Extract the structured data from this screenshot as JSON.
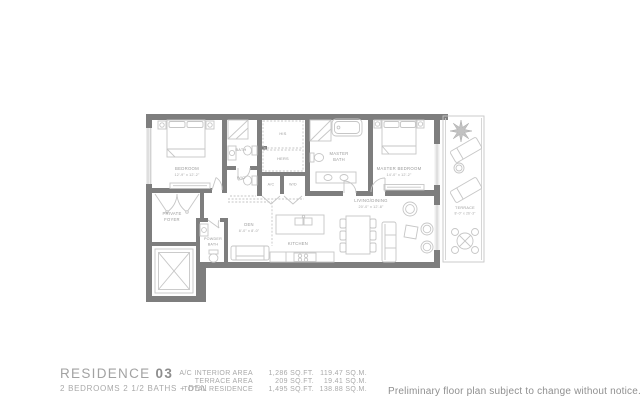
{
  "footer": {
    "residence_label": "RESIDENCE",
    "residence_number": "03",
    "subtitle": "2 BEDROOMS 2 1/2 BATHS + DEN",
    "stats": [
      {
        "label": "A/C INTERIOR AREA",
        "sqft": "1,286 SQ.FT.",
        "sqm": "119.47 SQ.M."
      },
      {
        "label": "TERRACE AREA",
        "sqft": "209 SQ.FT.",
        "sqm": "19.41 SQ.M."
      },
      {
        "label": "TOTAL RESIDENCE",
        "sqft": "1,495 SQ.FT.",
        "sqm": "138.88 SQ.M."
      }
    ],
    "disclaimer": "Preliminary floor plan subject to change without notice."
  },
  "plan": {
    "rooms": {
      "bedroom": {
        "label": "BEDROOM",
        "dims": "12'-9\" x 12'-2\""
      },
      "bath": {
        "label": "BATH"
      },
      "wc": {
        "label": "W/C"
      },
      "his": {
        "label": "HIS"
      },
      "hers": {
        "label": "HERS"
      },
      "ac": {
        "label": "A/C"
      },
      "wd": {
        "label": "W/D"
      },
      "master_bath": {
        "line1": "MASTER",
        "line2": "BATH"
      },
      "master_bedroom": {
        "label": "MASTER BEDROOM",
        "dims": "14'-0\" x 12'-2\""
      },
      "living_dining": {
        "label": "LIVING/DINING",
        "dims": "20'-0\" x 12'-8\""
      },
      "private_foyer": {
        "line1": "PRIVATE",
        "line2": "FOYER"
      },
      "powder_bath": {
        "line1": "POWDER",
        "line2": "BATH"
      },
      "den": {
        "label": "DEN",
        "dims": "8'-0\" x 8'-0\""
      },
      "kitchen": {
        "label": "KITCHEN"
      },
      "terrace": {
        "label": "TERRACE",
        "dims": "8'-0\" x 26'-3\""
      }
    },
    "colors": {
      "wall": "#7e7e7e",
      "fixture": "#c6c6c6",
      "label": "#9a9a9a"
    }
  }
}
